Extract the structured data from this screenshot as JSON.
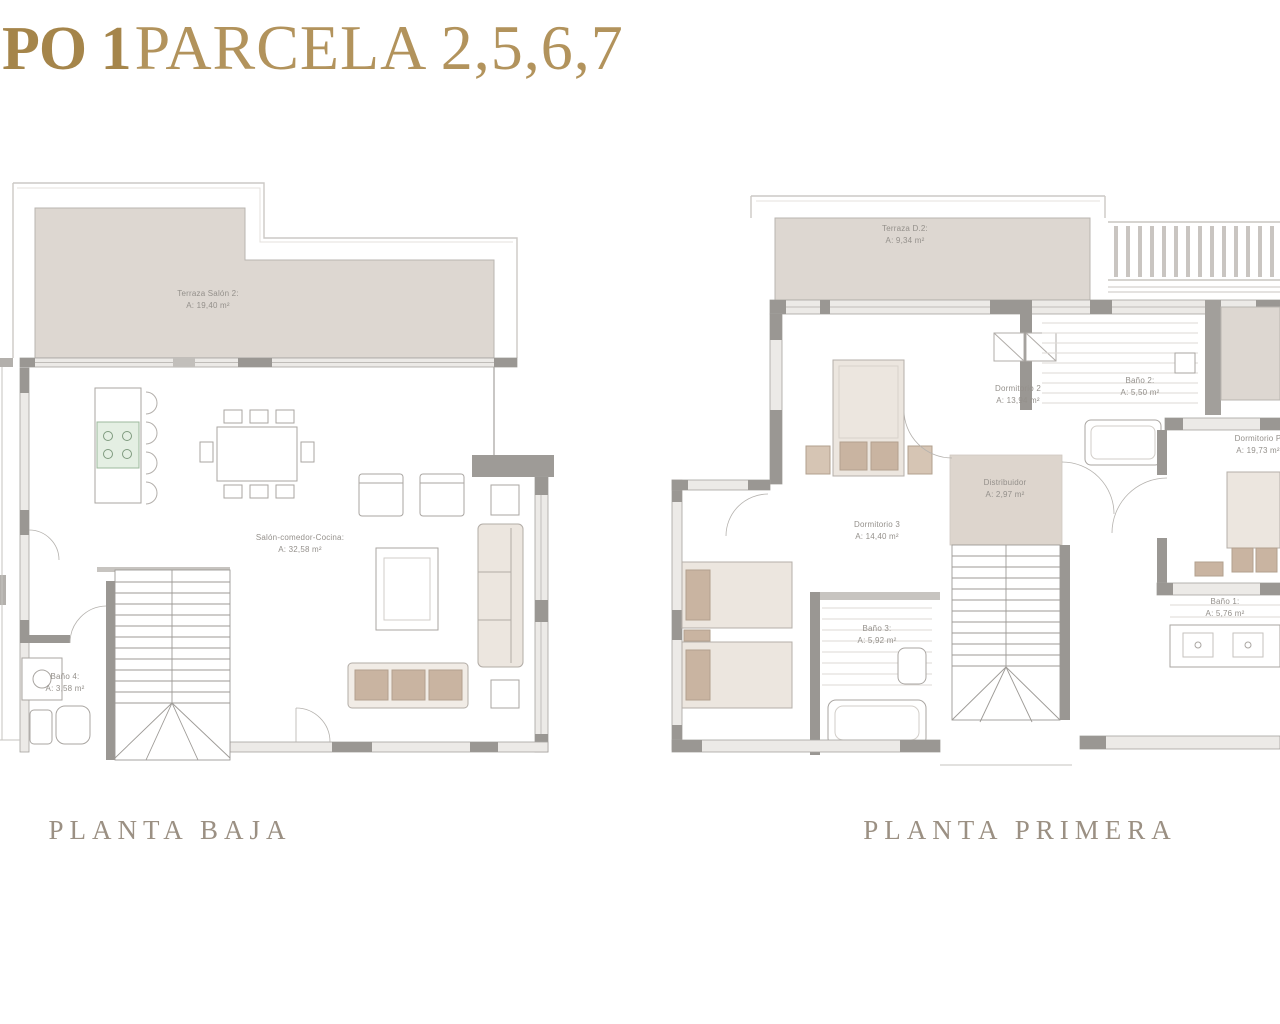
{
  "title": {
    "prefix": "PO 1",
    "rest": "PARCELA 2,5,6,7"
  },
  "colors": {
    "title_gold_bold": "#a5854a",
    "title_gold": "#b2935c",
    "plan_title_grey": "#9b9083",
    "label_grey": "#94908b",
    "terrace_fill": "#ddd7d1",
    "distributor_fill": "#ddd5cd",
    "wall_dark": "#9a9793",
    "wall_light": "#eceae7",
    "furniture_fill": "#ece6df",
    "cushion_tan": "#c9b4a1",
    "cooktop_green": "#e4efe3"
  },
  "plans": {
    "ground": {
      "name": "PLANTA BAJA",
      "rooms": [
        {
          "label": "Terraza Salón 2:",
          "area": "A: 19,40 m²"
        },
        {
          "label": "Salón-comedor-Cocina:",
          "area": "A: 32,58 m²"
        },
        {
          "label": "Baño 4:",
          "area": "A: 3,58 m²"
        }
      ]
    },
    "first": {
      "name": "PLANTA PRIMERA",
      "rooms": [
        {
          "label": "Terraza D.2:",
          "area": "A: 9,34 m²"
        },
        {
          "label": "Dormitorio 2",
          "area": "A: 13,94 m²"
        },
        {
          "label": "Baño 2:",
          "area": "A: 5,50 m²"
        },
        {
          "label": "Dormitorio P",
          "area": "A: 19,73 m²"
        },
        {
          "label": "Distribuidor",
          "area": "A: 2,97 m²"
        },
        {
          "label": "Dormitorio 3",
          "area": "A: 14,40 m²"
        },
        {
          "label": "Baño 3:",
          "area": "A: 5,92 m²"
        },
        {
          "label": "Baño 1:",
          "area": "A: 5,76 m²"
        }
      ]
    }
  }
}
